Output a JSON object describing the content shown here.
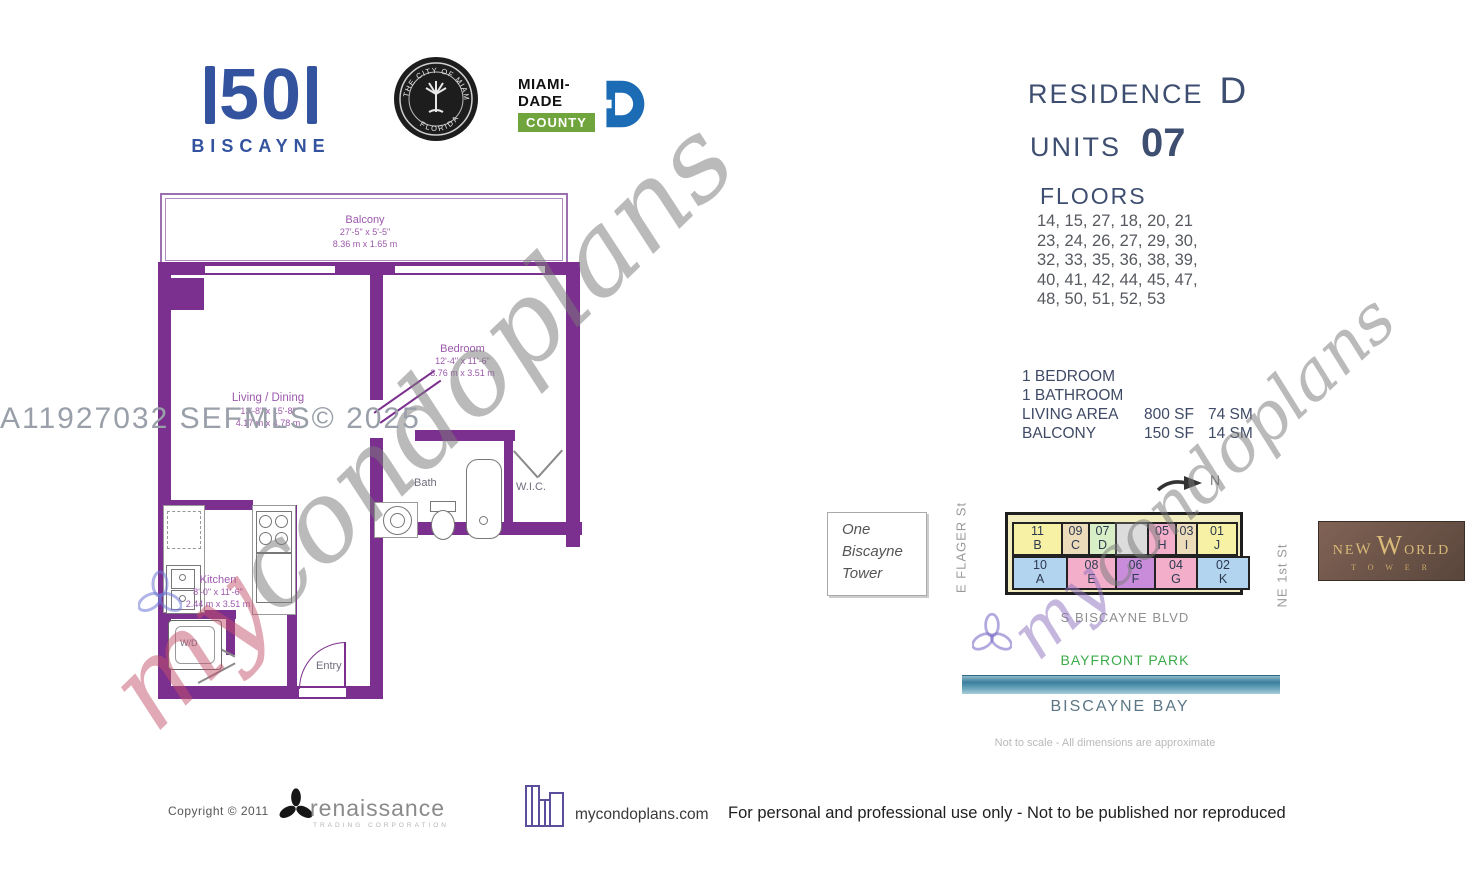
{
  "logos": {
    "fifty_number": "50",
    "fifty_name": "BISCAYNE",
    "seal_top": "THE CITY OF MIAMI",
    "seal_bottom": "FLORIDA",
    "miami_dade_line1": "MIAMI-DADE",
    "miami_dade_line2": "COUNTY"
  },
  "header": {
    "residence_label": "RESIDENCE",
    "residence_value": "D",
    "units_label": "UNITS",
    "units_value": "07",
    "floors_label": "FLOORS",
    "floors_lines": [
      "14, 15, 27, 18, 20, 21",
      "23, 24, 26, 27, 29, 30,",
      "32, 33, 35, 36, 38, 39,",
      "40, 41, 42, 44, 45, 47,",
      "48, 50, 51, 52, 53"
    ]
  },
  "summary": {
    "line1": "1 BEDROOM",
    "line2": "1 BATHROOM",
    "rows": [
      {
        "label": "LIVING AREA",
        "sf": "800 SF",
        "sm": "74 SM"
      },
      {
        "label": "BALCONY",
        "sf": "150 SF",
        "sm": "14 SM"
      }
    ]
  },
  "floorplan": {
    "balcony": {
      "name": "Balcony",
      "dim_ft": "27'-5\" x 5'-5\"",
      "dim_m": "8.36 m x 1.65 m"
    },
    "bedroom": {
      "name": "Bedroom",
      "dim_ft": "12'-4\" x 11'-6\"",
      "dim_m": "3.76 m x 3.51 m"
    },
    "living": {
      "name": "Living / Dining",
      "dim_ft": "13'-8\" x 15'-8\"",
      "dim_m": "4.17 m x 4.78 m"
    },
    "bath": {
      "name": "Bath"
    },
    "wic": {
      "name": "W.I.C."
    },
    "kitchen": {
      "name": "Kitchen",
      "dim_ft": "8'-0\" x 11'-6\"",
      "dim_m": "2.44 m x 3.51 m"
    },
    "wd": {
      "name": "W/D"
    },
    "entry": {
      "name": "Entry"
    }
  },
  "watermarks": {
    "mls": "A11927032  SEFMLS© 2025",
    "script_my": "my",
    "script_rest": "condoplans"
  },
  "sitemap": {
    "one_biscayne": "One\nBiscayne\nTower",
    "north": "N",
    "street_left": "E FLAGER St",
    "street_right": "NE 1st St",
    "street_bottom": "S BISCAYNE BLVD",
    "park": "BAYFRONT PARK",
    "bay": "BISCAYNE BAY",
    "note": "Not to scale - All dimensions are approximate",
    "cells_top": [
      {
        "num": "11",
        "letter": "B"
      },
      {
        "num": "09",
        "letter": "C"
      },
      {
        "num": "07",
        "letter": "D"
      },
      {
        "num": "",
        "letter": ""
      },
      {
        "num": "05",
        "letter": "H"
      },
      {
        "num": "03",
        "letter": "I"
      },
      {
        "num": "01",
        "letter": "J"
      }
    ],
    "cells_bottom": [
      {
        "num": "10",
        "letter": "A"
      },
      {
        "num": "08",
        "letter": "E"
      },
      {
        "num": "06",
        "letter": "F"
      },
      {
        "num": "04",
        "letter": "G"
      },
      {
        "num": "02",
        "letter": "K"
      }
    ]
  },
  "colors": {
    "unit_yellow": "#f6f1a4",
    "unit_tan": "#ecdcba",
    "unit_green": "#d8eec6",
    "unit_gray": "#dcdcdc",
    "unit_pink": "#f3aeca",
    "unit_blue": "#b2d4ee",
    "unit_purple": "#c98cda",
    "wall_purple": "#7b2f8e",
    "park_green": "#3cab4a",
    "water_teal": "#4a8ca8",
    "logo_blue": "#33539e",
    "dade_blue": "#1b6cb5",
    "dade_green": "#6fa53c",
    "gold": "#d8b978"
  },
  "new_world": {
    "pre": "NE",
    "big": "W",
    "post": " ",
    "big2": "W",
    "post2": "ORLD",
    "sub": "T  O  W  E  R"
  },
  "footer": {
    "copyright": "Copyright  ©   2011",
    "renaissance": "renaissance",
    "renaissance_sub": "TRADING CORPORATION",
    "site": "mycondoplans.com",
    "disclaimer": "For personal and professional use only - Not to be published nor reproduced"
  }
}
